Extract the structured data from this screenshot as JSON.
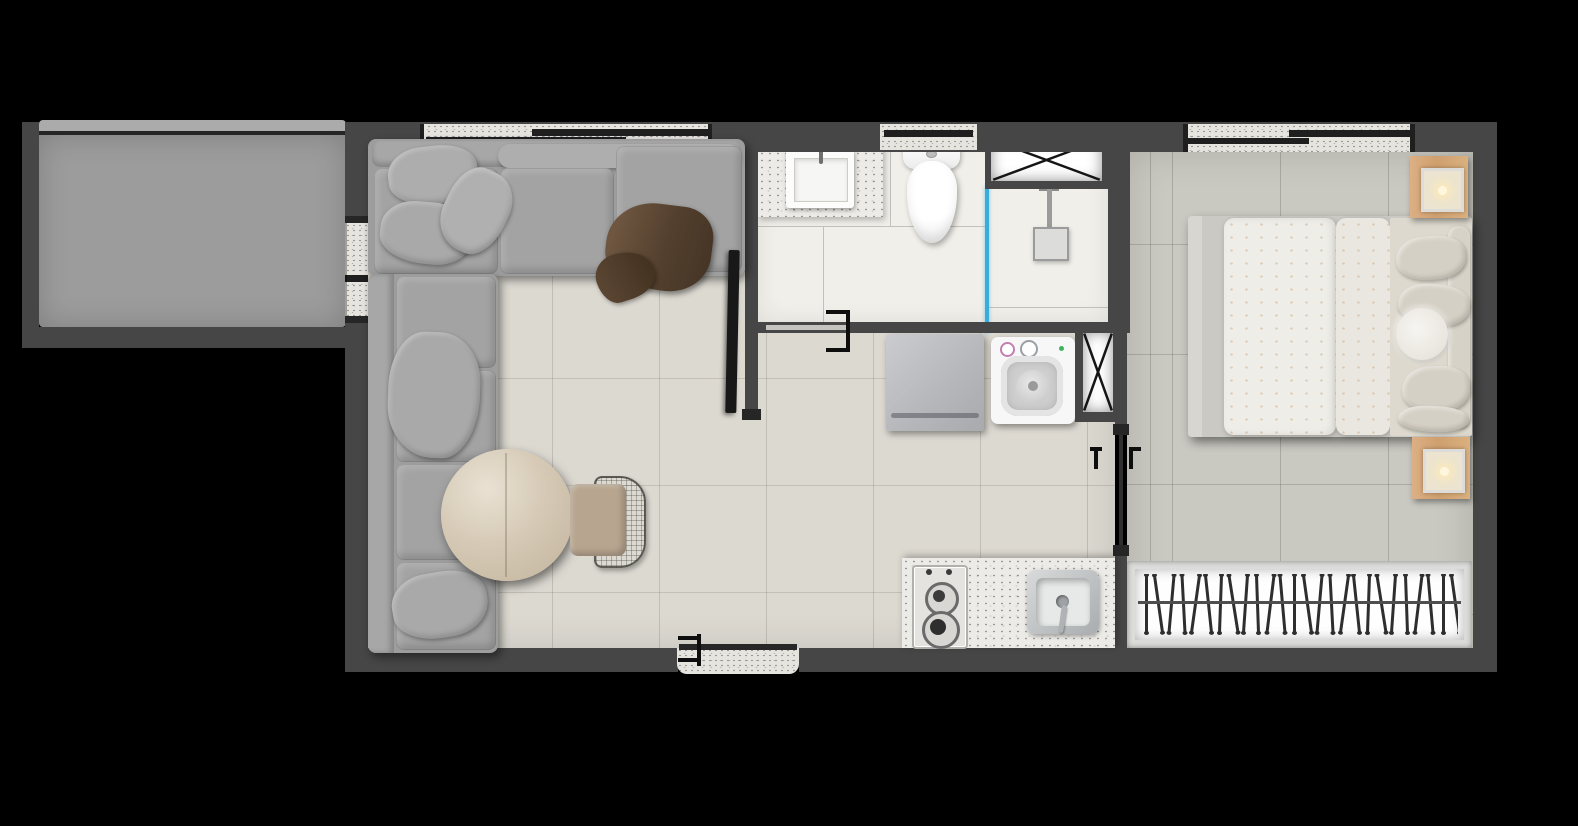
{
  "scene": {
    "type": "apartment-floor-plan-top-view",
    "background": "#000000",
    "units_visible_text": "none"
  },
  "palette": {
    "wall": "#464646",
    "wall_cap": "#262626",
    "balcony_floor": "#9c9c9c",
    "balcony_rail": "#ababab",
    "living_floor": "#dcd9d1",
    "bedroom_floor": "#c9c8c1",
    "bathroom_floor": "#f1efe9",
    "window_sill": "#e6e4df",
    "window_pane": "#1f1f1f",
    "granite": "#edebe7",
    "sofa": "#9d9d9d",
    "sofa_cushion": "#a3a3a3",
    "throw": "#5e4a38",
    "marble": "#d6cab6",
    "chair_seat": "#b7a58f",
    "tv": "#181818",
    "shower_glass": "#3aabdd",
    "wood": "#d2a477",
    "linen": "#efede7",
    "appliance_gray": "#bcbdc0",
    "appliance_white": "#f7f7f7",
    "hanger": "#2e2e2e"
  },
  "rooms": [
    "balcony",
    "living-room",
    "bathroom",
    "kitchen-laundry-hall",
    "bedroom",
    "wardrobe"
  ],
  "furniture": {
    "living_room": [
      "l-shaped-sofa",
      "throw-pillows",
      "brown-throw-blanket",
      "round-marble-table",
      "wire-frame-chair",
      "wall-mounted-tv"
    ],
    "bathroom": [
      "granite-vanity-with-sink",
      "toilet",
      "glass-shower-divider",
      "shower-column",
      "duct-shaft-crossed"
    ],
    "kitchen_laundry": [
      "refrigerator",
      "top-load-washing-machine",
      "duct-shaft-crossed",
      "granite-counter",
      "two-burner-cooktop",
      "kitchen-sink-with-faucet"
    ],
    "bedroom": [
      "double-bed-with-duvets",
      "bed-pillows",
      "fur-pillow",
      "nightstand-with-lamp-top",
      "nightstand-with-lamp-bottom",
      "wardrobe-rail-with-hangers"
    ]
  },
  "closet": {
    "hanger_count": 26
  },
  "openings": {
    "balcony_sliding_door": "left-wall",
    "living_room_window": "top-wall",
    "bathroom_window": "top-wall",
    "bedroom_window": "top-wall",
    "bathroom_sliding_door": "bathroom-south-wall",
    "bedroom_sliding_door": "bedroom-west-wall",
    "entrance_door": "bottom-wall"
  }
}
